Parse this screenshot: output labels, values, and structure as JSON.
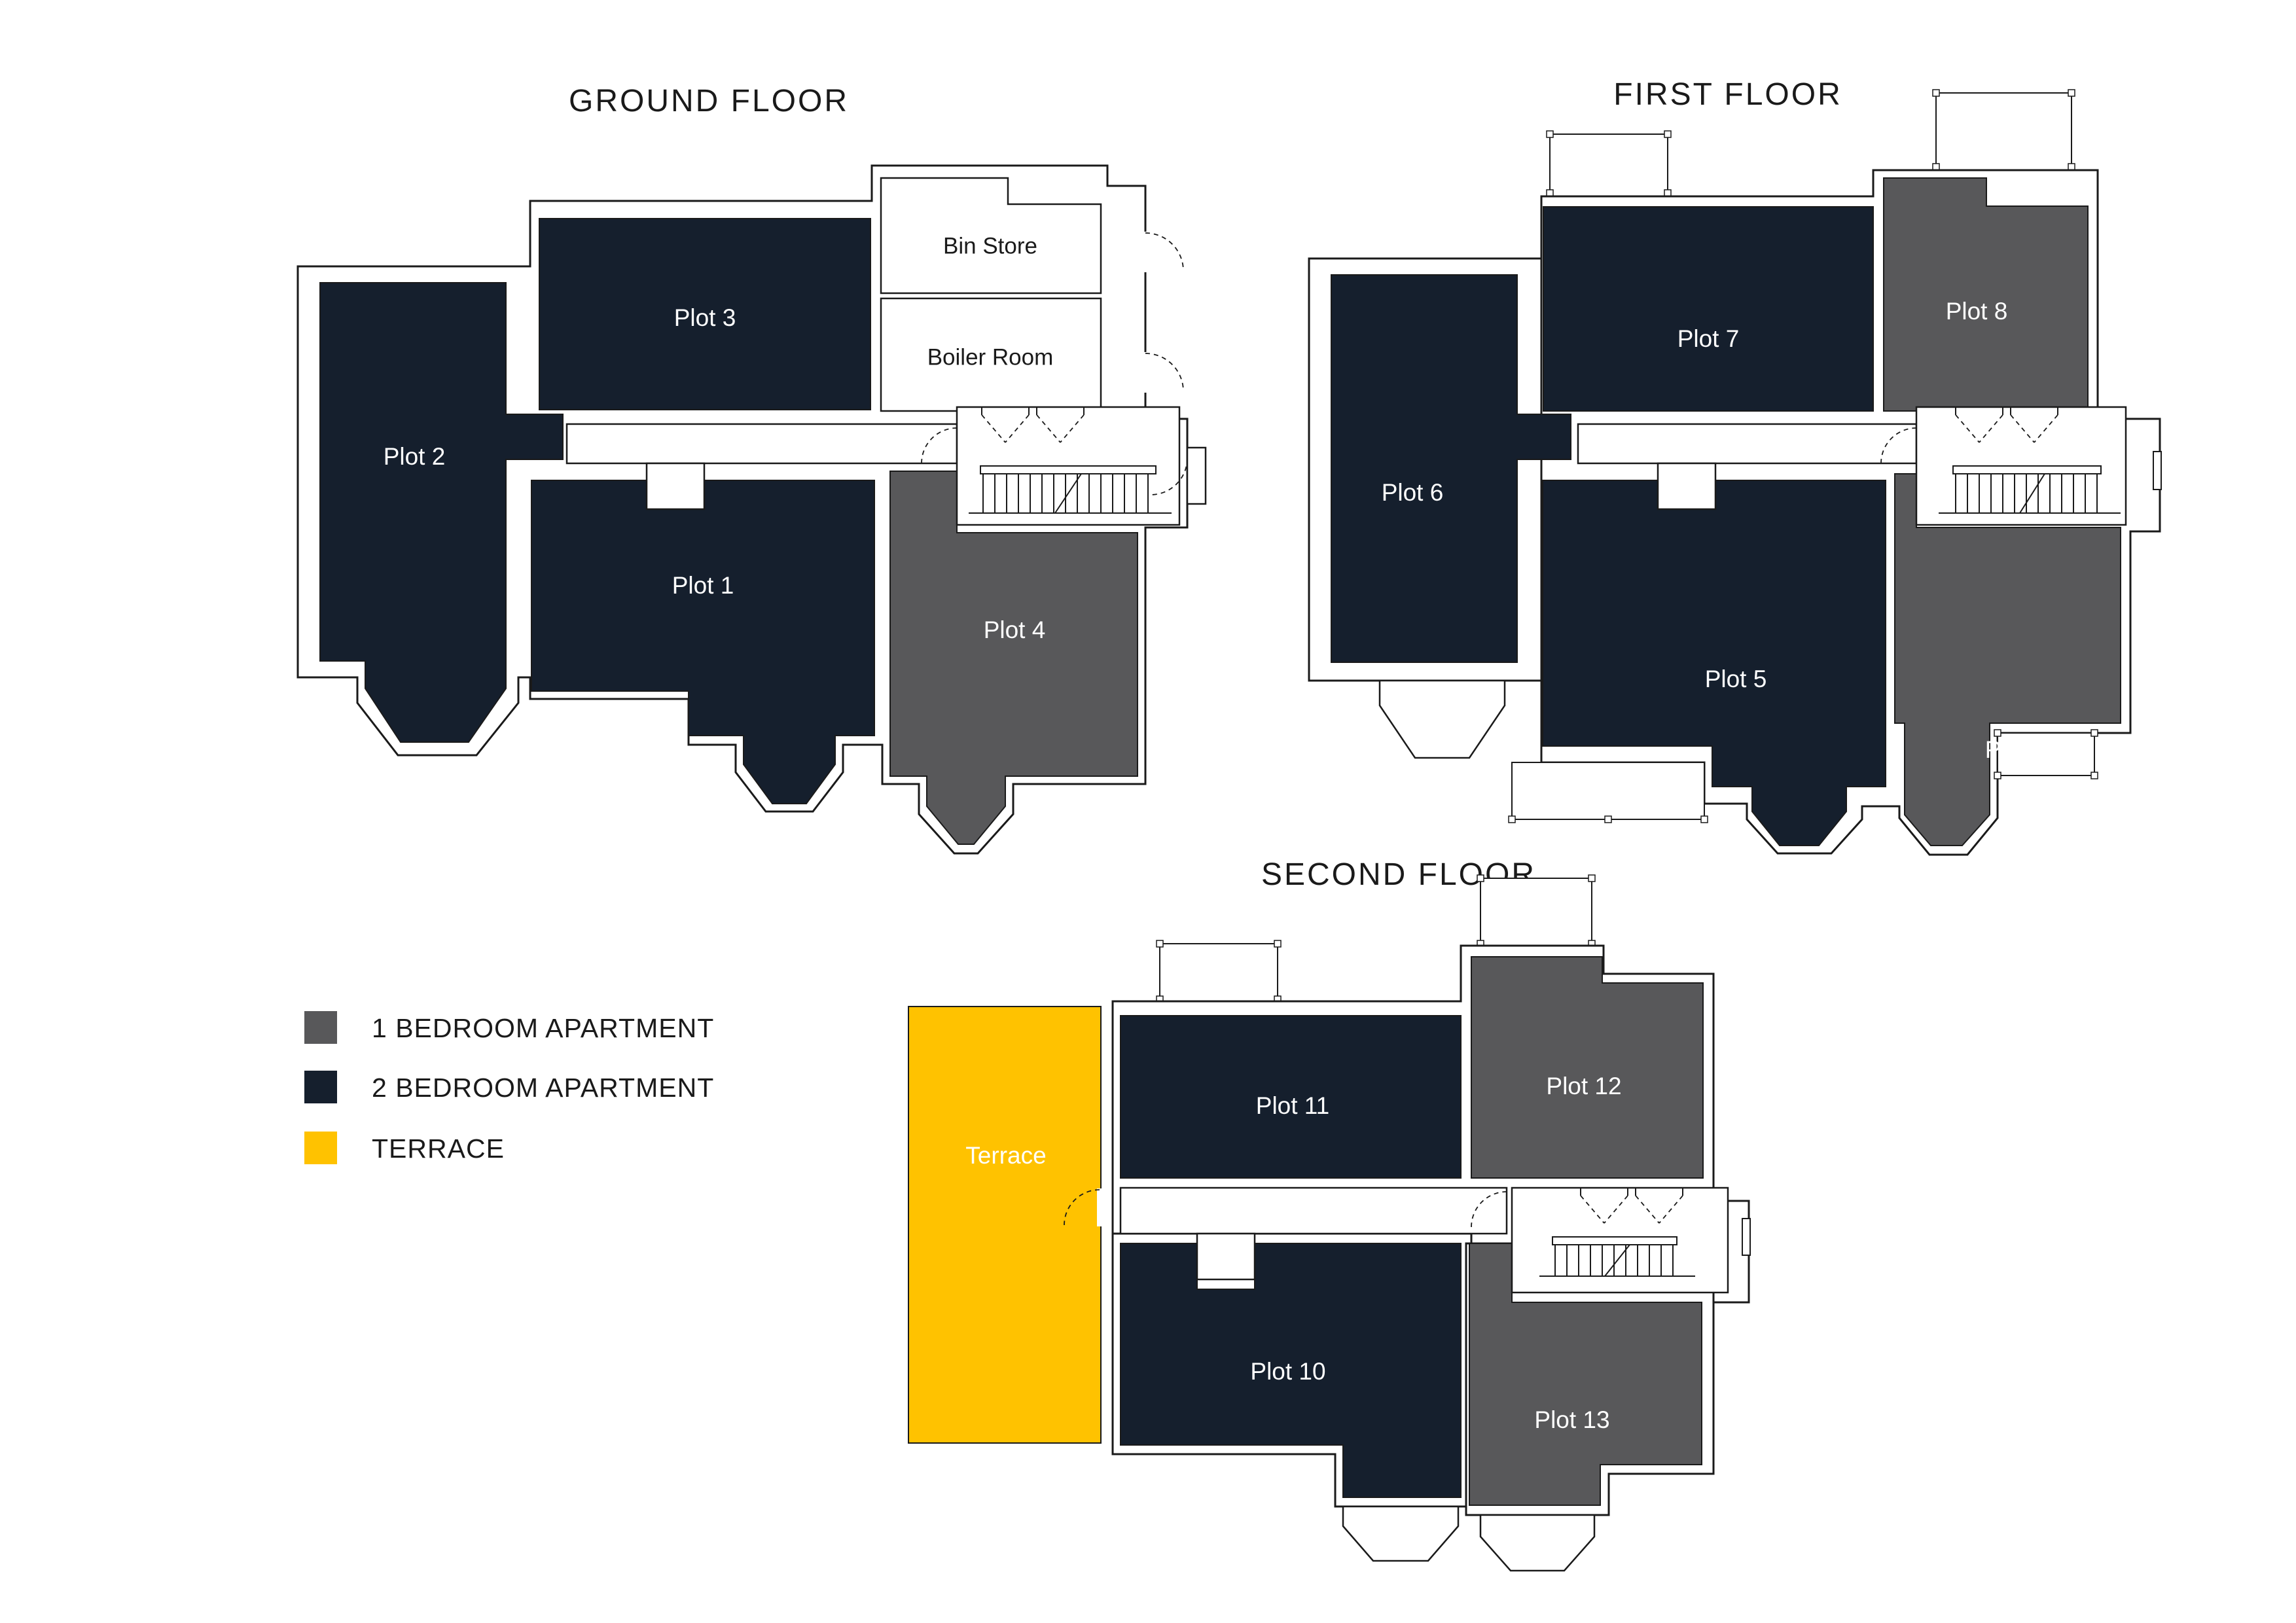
{
  "colors": {
    "one_bed": "#58585A",
    "two_bed": "#151F2D",
    "terrace": "#FFC200",
    "outline": "#1A1A1A"
  },
  "floors": {
    "ground": {
      "title": "GROUND FLOOR",
      "labels": {
        "plot1": "Plot 1",
        "plot2": "Plot 2",
        "plot3": "Plot 3",
        "plot4": "Plot 4",
        "bin_store": "Bin Store",
        "boiler_room": "Boiler Room"
      }
    },
    "first": {
      "title": "FIRST FLOOR",
      "labels": {
        "plot5": "Plot 5",
        "plot6": "Plot 6",
        "plot7": "Plot 7",
        "plot8": "Plot 8",
        "plot9": "Plot 9"
      }
    },
    "second": {
      "title": "SECOND FLOOR",
      "labels": {
        "plot10": "Plot 10",
        "plot11": "Plot 11",
        "plot12": "Plot 12",
        "plot13": "Plot 13",
        "terrace": "Terrace"
      }
    }
  },
  "legend": {
    "items": [
      {
        "label": "1 BEDROOM APARTMENT",
        "color": "#58585A"
      },
      {
        "label": "2 BEDROOM APARTMENT",
        "color": "#151F2D"
      },
      {
        "label": "TERRACE",
        "color": "#FFC200"
      }
    ]
  }
}
